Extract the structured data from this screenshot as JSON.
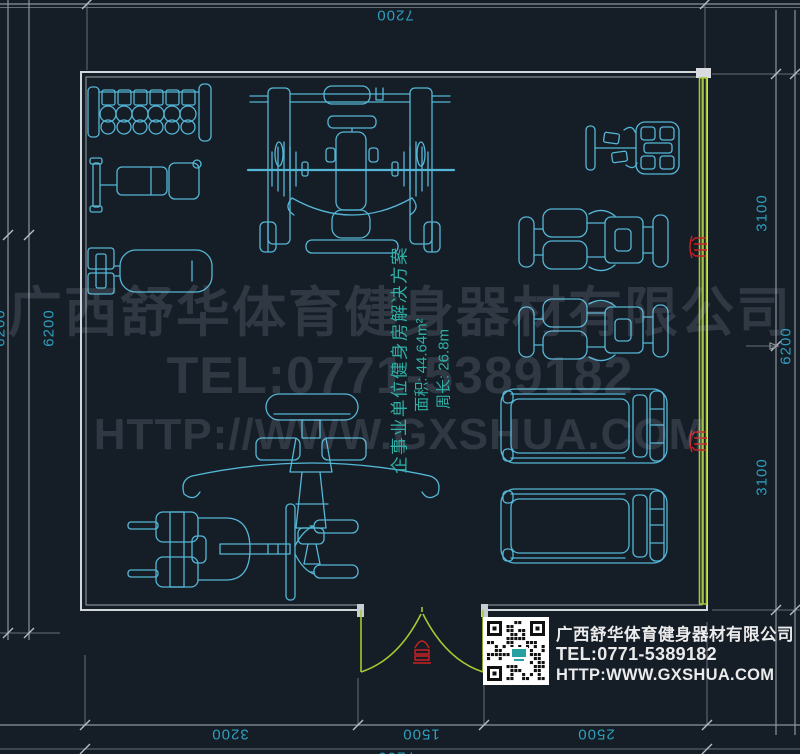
{
  "colors": {
    "background": "#151d27",
    "equipment_line": "#55b7d6",
    "wall_line": "#d2d7dc",
    "window_line": "#a6c832",
    "dimension_text": "#2f9fbd",
    "room_label_text": "#2fb0a6",
    "marker_red": "#cc2222",
    "watermark_text": "#39434f",
    "info_text": "#ebebeb"
  },
  "dims": {
    "top_total": "7200",
    "left_total": "6200",
    "left_edge_partial": "6200",
    "right_upper": "3100",
    "right_lower": "3100",
    "right_total": "6200",
    "bottom_left": "3200",
    "bottom_door": "1500",
    "bottom_right": "2500",
    "bottom_total": "7200"
  },
  "room_label": {
    "title": "企事业单位健身房解决方案",
    "area": "面积: 44.64m²",
    "perimeter": "周长: 26.8m"
  },
  "watermark": {
    "company": "广西舒华体育健身器材有限公司",
    "tel": "TEL:0771-5389182",
    "url": "HTTP://WWW.GXSHUA.COM"
  },
  "info_box": {
    "company": "广西舒华体育健身器材有限公司",
    "tel": "TEL:0771-5389182",
    "url": "HTTP:WWW.GXSHUA.COM"
  }
}
